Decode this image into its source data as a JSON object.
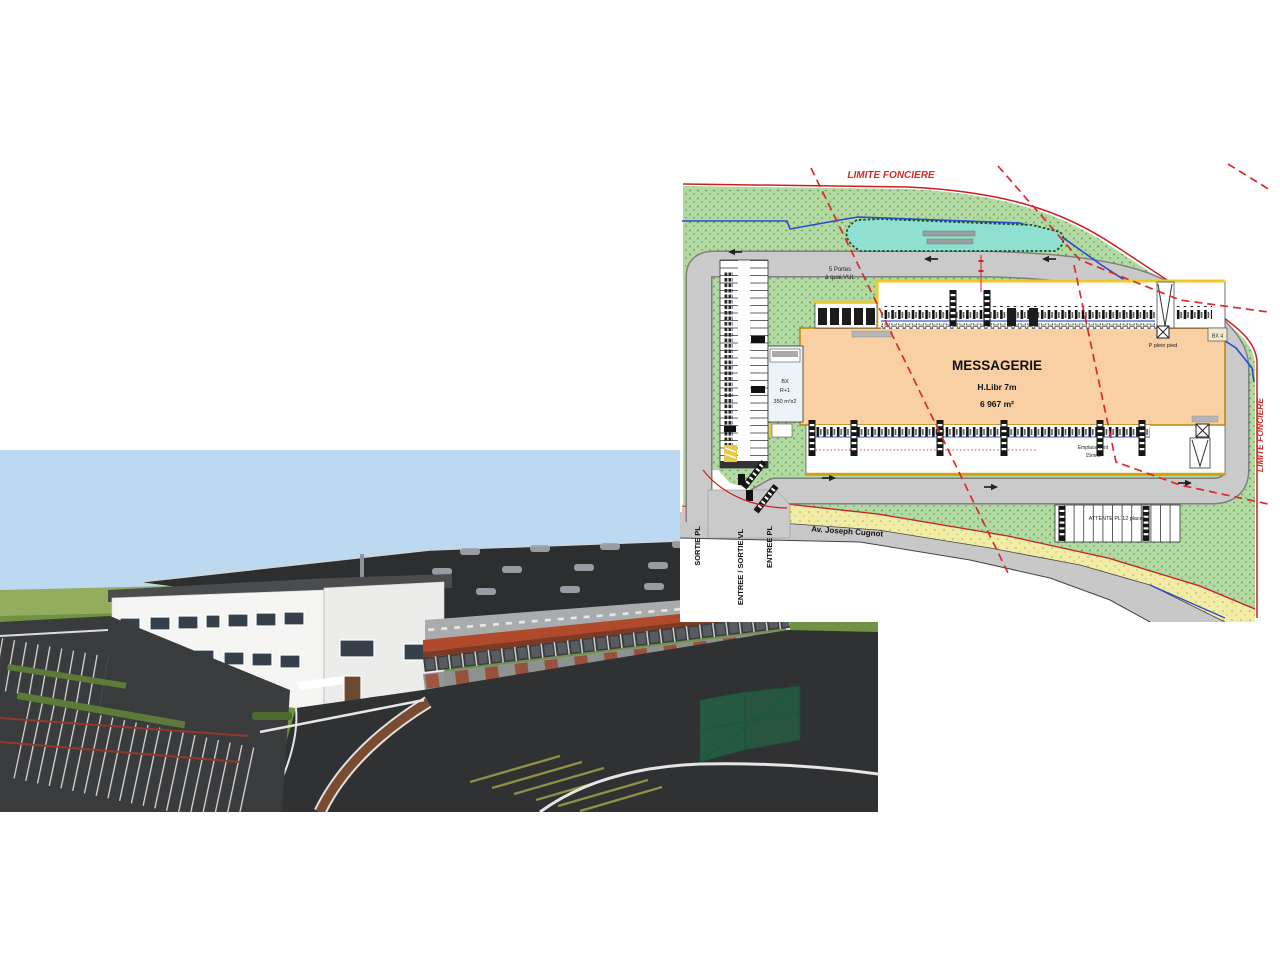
{
  "slide": {
    "background": "#ffffff"
  },
  "render_3d": {
    "description": "3D rendering of the messagerie logistics building",
    "colors": {
      "sky": "#bcd9f2",
      "grass": "#6f9243",
      "roof": "#2d2e30",
      "office_wall": "#f5f5f3",
      "canopy": "#b14a2c",
      "asphalt": "#303133"
    }
  },
  "site_plan": {
    "colors": {
      "landscape": "#b2d9a2",
      "road": "#cacaca",
      "basin": "#8fe0d0",
      "warehouse_fill": "#f8d0a4",
      "boundary_red": "#d92b2b",
      "water_blue": "#2b4bd0",
      "path_yellow": "#f2eda6"
    },
    "boundary": {
      "top_label": "LIMITE FONCIERE",
      "right_label": "LIMITE FONCIERE"
    },
    "street": {
      "name_label": "Av. Joseph Cugnot"
    },
    "gates": {
      "exit_trucks": "SORTIE PL",
      "entry_exit_cars": "ENTREE / SORTIE VL",
      "entry_trucks": "ENTREE PL"
    },
    "warehouse": {
      "name": "MESSAGERIE",
      "clear_height": "H.Libr 7m",
      "area": "6 967 m²"
    },
    "office": {
      "line1": "BX",
      "line2": "R+1",
      "line3": "350 m²x2"
    },
    "vul_docks": {
      "line1": "5 Portes",
      "line2": "à quai VUL"
    },
    "ground_level_door": {
      "label": "P plein pied"
    },
    "bx4": {
      "label": "BX 4"
    },
    "south_apron": {
      "line1": "Emplacement",
      "line2": "15mns"
    },
    "waiting_area": {
      "label": "ATTENTE PL 12 places"
    }
  }
}
